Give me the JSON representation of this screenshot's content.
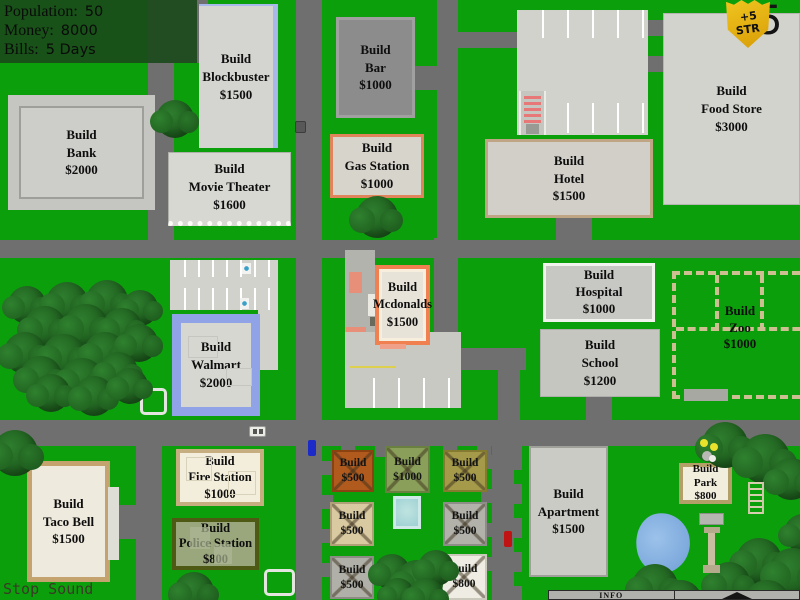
{
  "hud": {
    "population_label": "Population:",
    "population_value": "50",
    "money_label": "Money:",
    "money_value": "8000",
    "bills_label": "Bills:",
    "bills_value": "5 Days"
  },
  "badge": {
    "bonus_line1": "+5",
    "bonus_line2": "STR",
    "day_counter": "5"
  },
  "buildings": {
    "bank": [
      "Build",
      "Bank",
      "$2000"
    ],
    "blockbuster": [
      "Build",
      "Blockbuster",
      "$1500"
    ],
    "movie_theater": [
      "Build",
      "Movie Theater",
      "$1600"
    ],
    "bar": [
      "Build",
      "Bar",
      "$1000"
    ],
    "gas_station": [
      "Build",
      "Gas Station",
      "$1000"
    ],
    "hotel": [
      "Build",
      "Hotel",
      "$1500"
    ],
    "food_store": [
      "Build",
      "Food Store",
      "$3000"
    ],
    "mcdonalds": [
      "Build",
      "Mcdonalds",
      "$1500"
    ],
    "hospital": [
      "Build",
      "Hospital",
      "$1000"
    ],
    "school": [
      "Build",
      "School",
      "$1200"
    ],
    "zoo": [
      "Build",
      "Zoo",
      "$1000"
    ],
    "walmart": [
      "Build",
      "Walmart",
      "$2000"
    ],
    "taco_bell": [
      "Build",
      "Taco Bell",
      "$1500"
    ],
    "fire_station": [
      "Build",
      "Fire Station",
      "$1000"
    ],
    "police_station": [
      "Build",
      "Police Station",
      "$800"
    ],
    "apartment": [
      "Build",
      "Apartment",
      "$1500"
    ],
    "park": [
      "Build",
      "Park",
      "$800"
    ]
  },
  "plots": [
    {
      "lines": [
        "Build",
        "$500"
      ]
    },
    {
      "lines": [
        "Build",
        "$1000"
      ]
    },
    {
      "lines": [
        "Build",
        "$500"
      ]
    },
    {
      "lines": [
        "Build",
        "$500"
      ]
    },
    {
      "lines": [
        "Build",
        "$500"
      ]
    },
    {
      "lines": [
        "Build",
        "$500"
      ]
    },
    {
      "lines": [
        "Build",
        "$800"
      ]
    }
  ],
  "controls": {
    "stop_sound_label": "Stop Sound",
    "info_label": "INFO"
  },
  "colors": {
    "grass": "#0c9f0c",
    "road": "#6f6f6f",
    "hud_panel": "#1e4a1e",
    "badge_gold": "#e9b612",
    "blockbuster_blue": "#a8b8ea",
    "mcdonalds_orange": "#f08050",
    "gas_station_orange": "#e0845c",
    "walmart_blue": "#8fa3e6",
    "police_olive": "#4e5a14",
    "fire_tan": "#c6ae80",
    "pool_blue": "#9ed0d4",
    "pond_blue": "#7fa8dc"
  }
}
